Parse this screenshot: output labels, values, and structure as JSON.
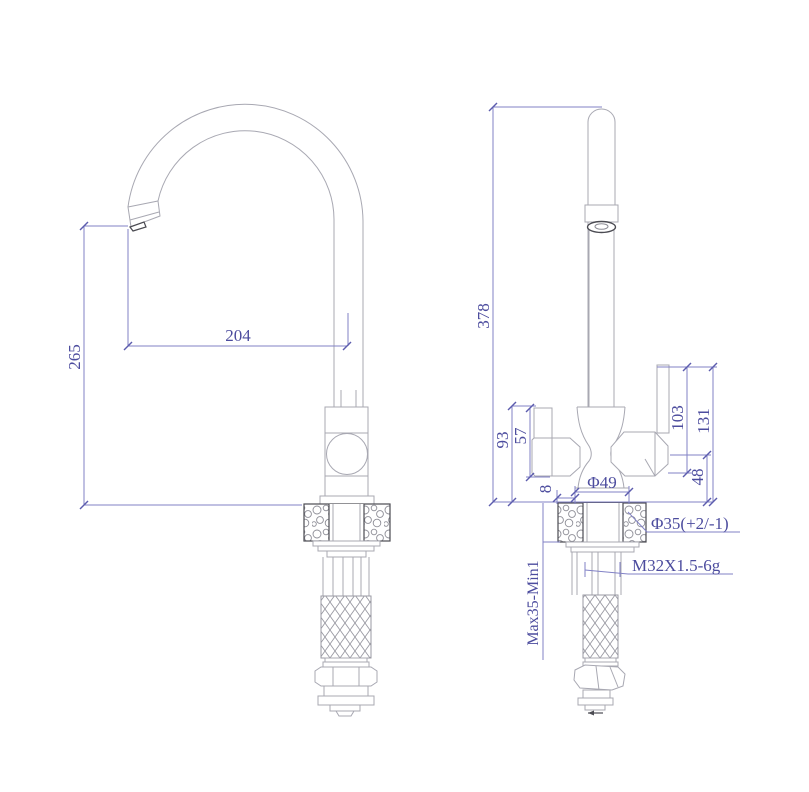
{
  "drawing": {
    "type": "technical-dimension-drawing",
    "subject": "kitchen faucet two-view CAD drawing",
    "colors": {
      "background": "#ffffff",
      "outline": "#a8a8b2",
      "dark_outline": "#4b4b52",
      "dimension_line": "#8282c6",
      "dimension_text": "#4c4c9e"
    },
    "views": {
      "side_view": {
        "name": "side view (gooseneck spout profile)",
        "dimensions": {
          "spout_reach": "204",
          "outlet_height": "265"
        }
      },
      "front_view": {
        "name": "front view (body with two handles)",
        "dimensions": {
          "overall_height": "378",
          "body_height": "93",
          "handle_height": "57",
          "lever_to_handle_bottom": "103",
          "lever_to_counter": "131",
          "handle_to_counter": "48",
          "base_offset": "8",
          "base_diameter": "Φ49",
          "mounting_hole": "Φ35(+2/-1)",
          "thread_spec": "M32X1.5-6g",
          "counter_thickness": "Max35-Min1"
        }
      }
    }
  }
}
